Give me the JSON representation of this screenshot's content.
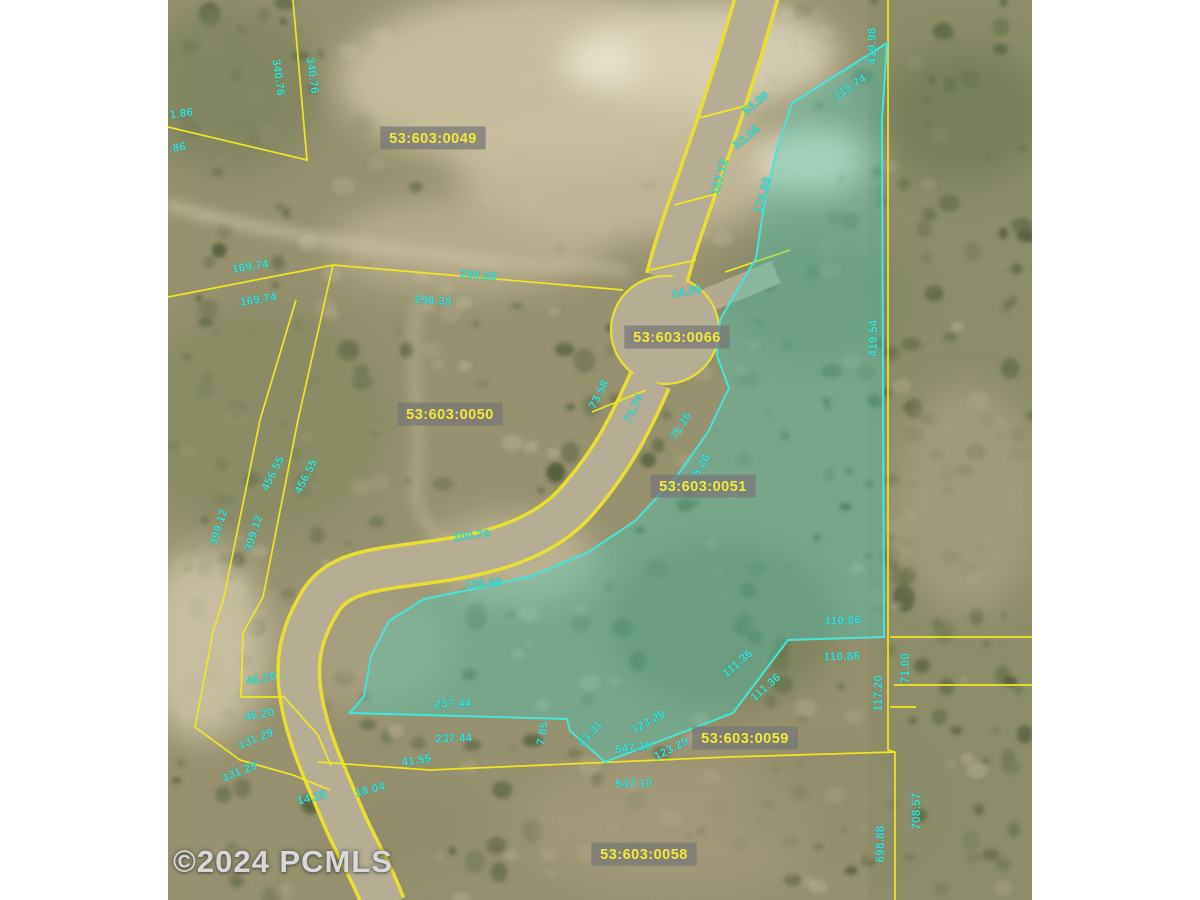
{
  "watermark": {
    "text": "©2024 PCMLS"
  },
  "map": {
    "type": "aerial-parcel-map",
    "colors": {
      "parcel_line": "#f0e71f",
      "road_fill": "#b6ad95",
      "highlight_fill": "rgba(70,205,188,0.36)",
      "highlight_line": "#3fe8da",
      "dimension_text": "#38e0d6",
      "parcel_label_text": "#f2e93a",
      "parcel_label_bg": "rgba(118,118,118,0.72)"
    },
    "parcel_labels": [
      {
        "id": "53:603:0049",
        "x": 265,
        "y": 138
      },
      {
        "id": "53:603:0050",
        "x": 282,
        "y": 414
      },
      {
        "id": "53:603:0066",
        "x": 509,
        "y": 337
      },
      {
        "id": "53:603:0051",
        "x": 535,
        "y": 486
      },
      {
        "id": "53:603:0059",
        "x": 577,
        "y": 738
      },
      {
        "id": "53:603:0058",
        "x": 476,
        "y": 854
      }
    ],
    "dimension_labels": [
      {
        "text": "340.76",
        "x": 107,
        "y": 78,
        "rot": 82
      },
      {
        "text": "340.76",
        "x": 141,
        "y": 76,
        "rot": 82
      },
      {
        "text": "1.86",
        "x": 14,
        "y": 117,
        "rot": -8
      },
      {
        "text": ".86",
        "x": 10,
        "y": 151,
        "rot": -8
      },
      {
        "text": "169.74",
        "x": 83,
        "y": 270,
        "rot": -9
      },
      {
        "text": "169.74",
        "x": 91,
        "y": 303,
        "rot": -9
      },
      {
        "text": "298.38",
        "x": 310,
        "y": 279,
        "rot": 4
      },
      {
        "text": "298.38",
        "x": 265,
        "y": 304,
        "rot": 4
      },
      {
        "text": "456.55",
        "x": 108,
        "y": 475,
        "rot": -63
      },
      {
        "text": "456.55",
        "x": 141,
        "y": 478,
        "rot": -63
      },
      {
        "text": "399.12",
        "x": 54,
        "y": 528,
        "rot": -73
      },
      {
        "text": "399.12",
        "x": 89,
        "y": 534,
        "rot": -73
      },
      {
        "text": "100.70",
        "x": 304,
        "y": 539,
        "rot": -7
      },
      {
        "text": "100.69",
        "x": 316,
        "y": 587,
        "rot": -4
      },
      {
        "text": "53.98",
        "x": 590,
        "y": 106,
        "rot": -38
      },
      {
        "text": "53.98",
        "x": 581,
        "y": 140,
        "rot": -38
      },
      {
        "text": "183.12",
        "x": 555,
        "y": 178,
        "rot": -74
      },
      {
        "text": "172.88",
        "x": 598,
        "y": 196,
        "rot": -74
      },
      {
        "text": "115.74",
        "x": 684,
        "y": 90,
        "rot": -33
      },
      {
        "text": "419.98",
        "x": 708,
        "y": 46,
        "rot": -90
      },
      {
        "text": "54.06",
        "x": 520,
        "y": 295,
        "rot": -12
      },
      {
        "text": "419.54",
        "x": 709,
        "y": 338,
        "rot": -90
      },
      {
        "text": "73.58",
        "x": 434,
        "y": 396,
        "rot": -64
      },
      {
        "text": "73.74",
        "x": 469,
        "y": 410,
        "rot": -64
      },
      {
        "text": "75.26",
        "x": 516,
        "y": 428,
        "rot": -60
      },
      {
        "text": "75.26",
        "x": 535,
        "y": 470,
        "rot": -60
      },
      {
        "text": "110.86",
        "x": 675,
        "y": 624,
        "rot": -2
      },
      {
        "text": "110.86",
        "x": 674,
        "y": 660,
        "rot": -2
      },
      {
        "text": "111.36",
        "x": 572,
        "y": 666,
        "rot": -41
      },
      {
        "text": "111.36",
        "x": 600,
        "y": 690,
        "rot": -41
      },
      {
        "text": "117.20",
        "x": 714,
        "y": 693,
        "rot": -90
      },
      {
        "text": "71.00",
        "x": 741,
        "y": 668,
        "rot": -90
      },
      {
        "text": "123.29",
        "x": 482,
        "y": 725,
        "rot": -27
      },
      {
        "text": "123.29",
        "x": 505,
        "y": 752,
        "rot": -27
      },
      {
        "text": "43.31",
        "x": 425,
        "y": 736,
        "rot": -47
      },
      {
        "text": "7.85",
        "x": 378,
        "y": 734,
        "rot": -80
      },
      {
        "text": "237.44",
        "x": 285,
        "y": 707,
        "rot": -2
      },
      {
        "text": "237.44",
        "x": 286,
        "y": 742,
        "rot": -2
      },
      {
        "text": "547.10",
        "x": 466,
        "y": 751,
        "rot": -7
      },
      {
        "text": "547.10",
        "x": 466,
        "y": 787,
        "rot": -2
      },
      {
        "text": "131.29",
        "x": 89,
        "y": 742,
        "rot": -22
      },
      {
        "text": "131.29",
        "x": 73,
        "y": 775,
        "rot": -22
      },
      {
        "text": "46.20",
        "x": 94,
        "y": 682,
        "rot": -10
      },
      {
        "text": "46.20",
        "x": 92,
        "y": 718,
        "rot": -10
      },
      {
        "text": "41.55",
        "x": 249,
        "y": 764,
        "rot": -8
      },
      {
        "text": "14.25",
        "x": 145,
        "y": 801,
        "rot": -14
      },
      {
        "text": "18.04",
        "x": 203,
        "y": 793,
        "rot": -14
      },
      {
        "text": "708.57",
        "x": 752,
        "y": 811,
        "rot": -90
      },
      {
        "text": "698.88",
        "x": 716,
        "y": 844,
        "rot": -90
      }
    ]
  }
}
